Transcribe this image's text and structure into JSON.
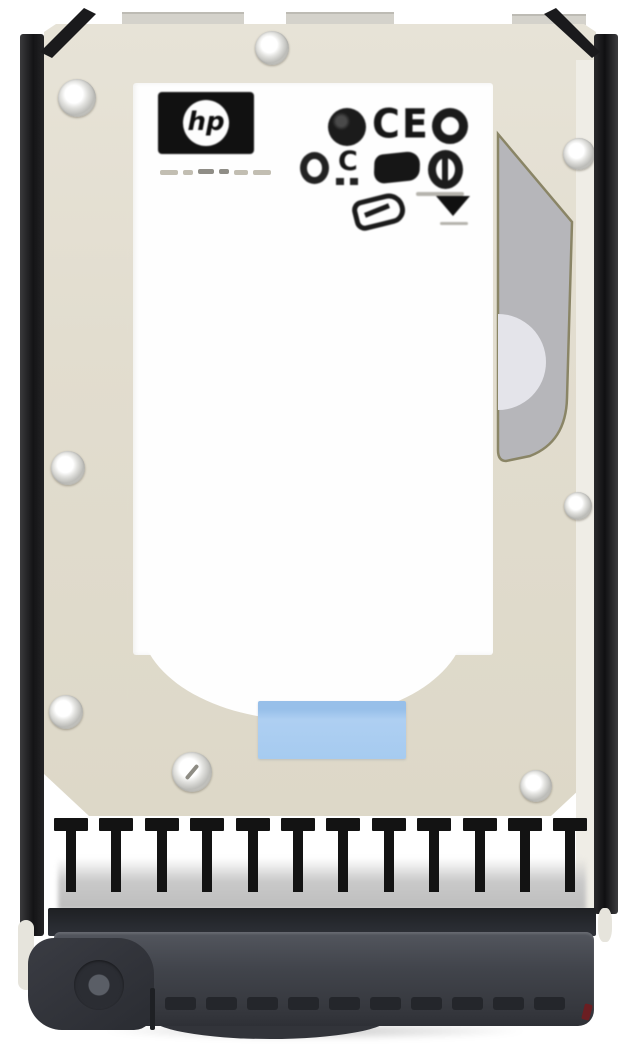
{
  "scene": {
    "type": "product-photo",
    "subject": "HP hot-swap hard disk drive mounted in a black carrier tray",
    "view": "top label view"
  },
  "branding": {
    "logo_text": "hp"
  },
  "label": {
    "background_color": "#fefefe",
    "certification_marks": {
      "ce_text": "CE",
      "icons": [
        "ul-circle-mark",
        "ce-mark",
        "ring-mark",
        "small-ring-mark",
        "c-ul-mark",
        "square-blob-mark",
        "circle-slash-mark",
        "oval-outline-mark",
        "triangle-mark"
      ]
    },
    "service_sticker_color": "#a9cdf1"
  },
  "carrier": {
    "rail_color": "#1a1a1c",
    "handle_color": "#3d4047",
    "emi_finger_count": 12,
    "grip_dash_count": 10
  },
  "drive": {
    "face_color": "#e1dccd",
    "spindle_panel_color": "#b6b6ba",
    "screw_count": 8
  }
}
